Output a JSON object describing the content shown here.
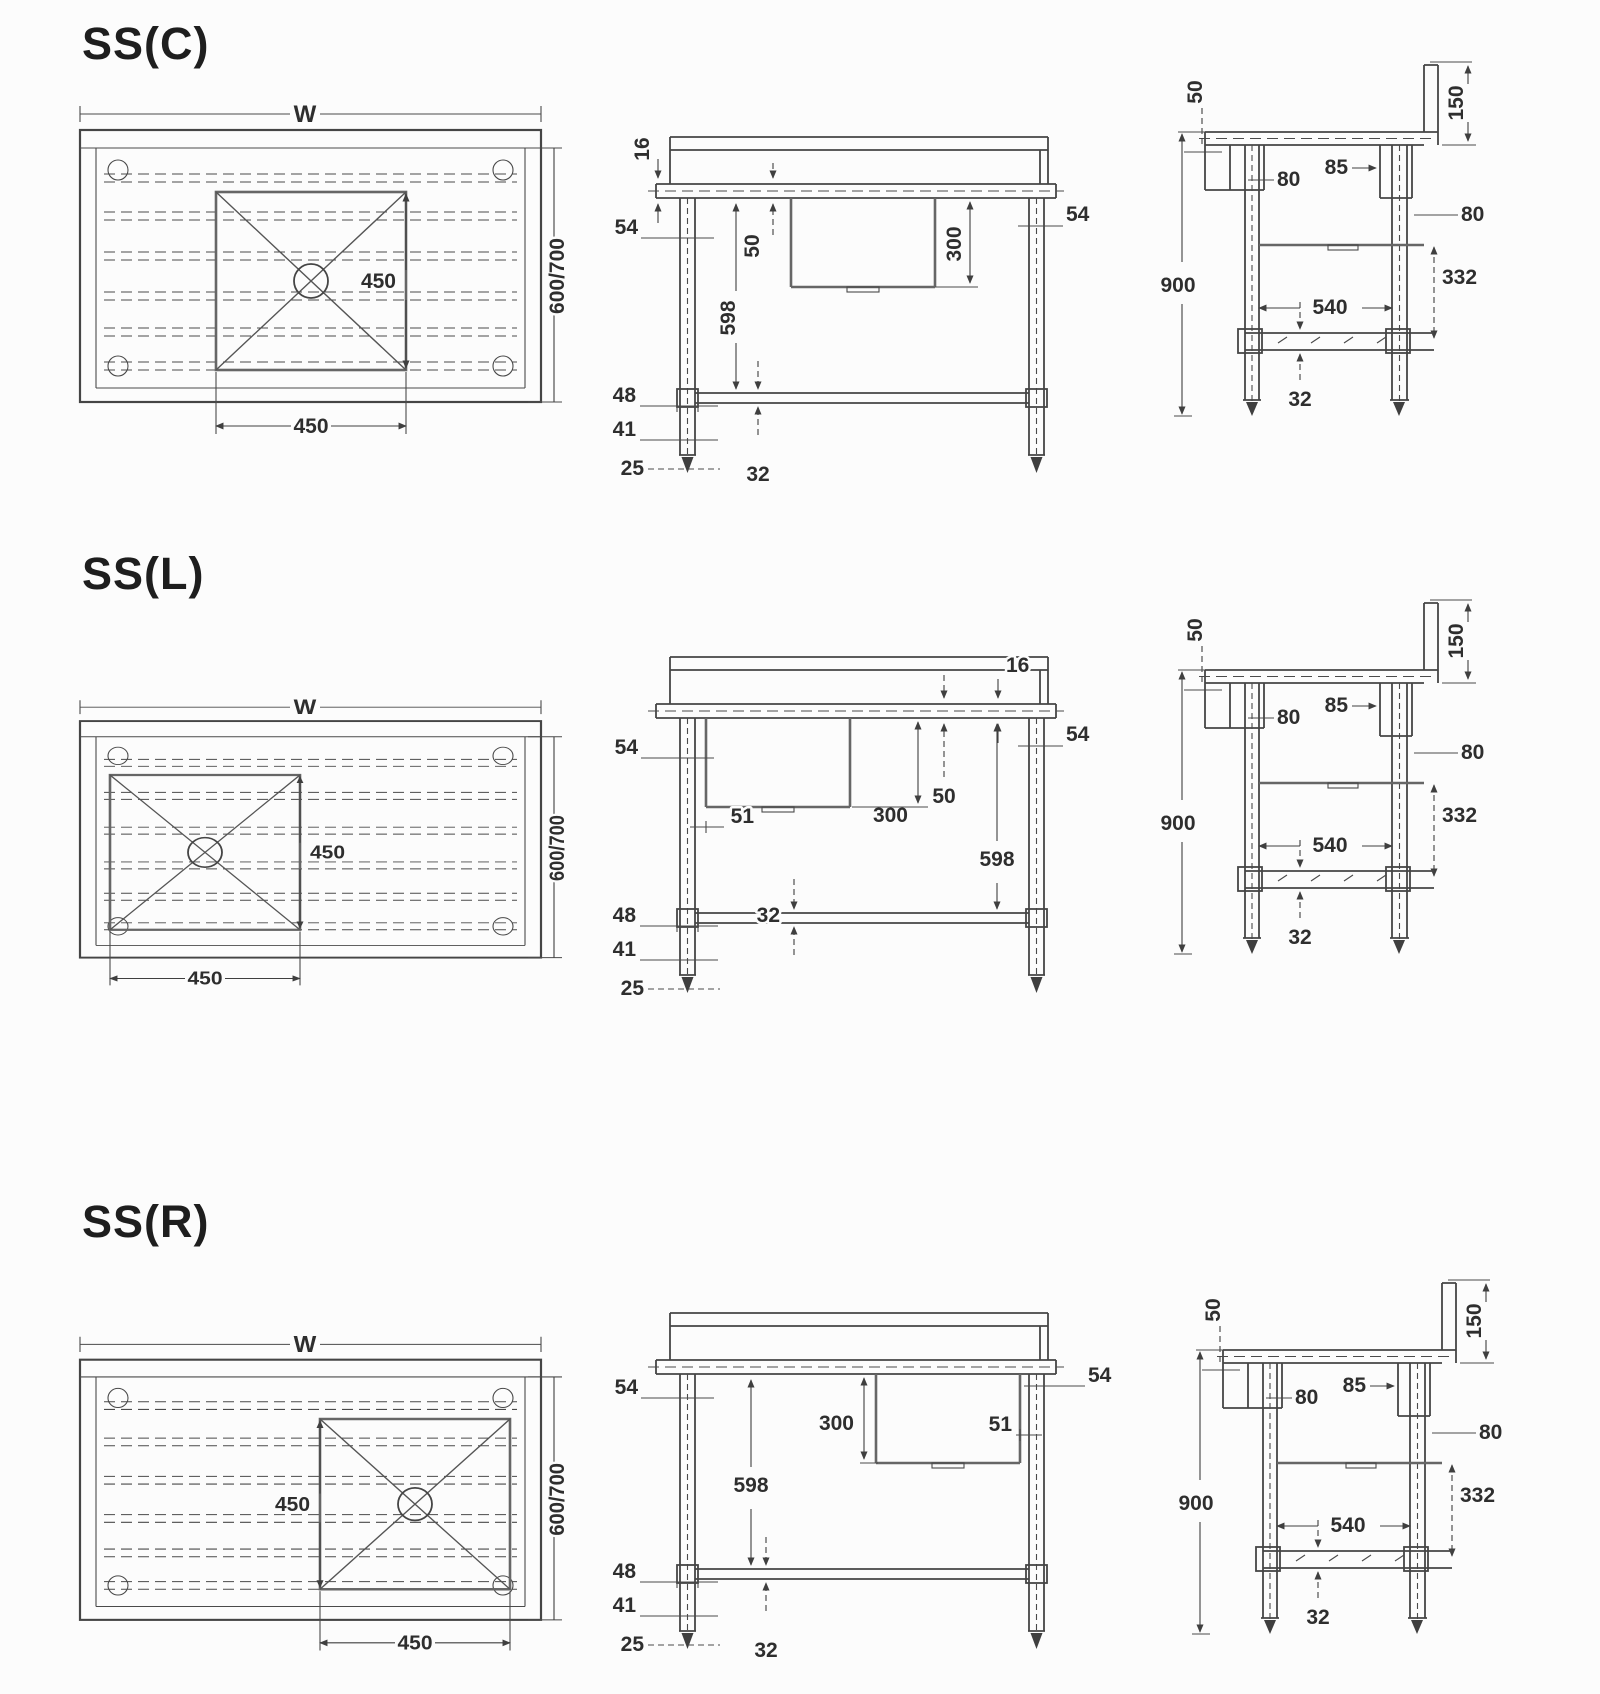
{
  "drawing": {
    "background": "#fcfcfc",
    "line_color": "#454545",
    "rows": [
      {
        "title": "SS(C)",
        "plan": {
          "width": "W",
          "depth": "600/700",
          "sink_side": "450",
          "sink_width": "450"
        },
        "front": {
          "top_thickness": "16",
          "left_leg": "54",
          "right_leg": "54",
          "apron": "50",
          "height": "598",
          "sink_depth": "300",
          "joint": "48",
          "leg": "41",
          "foot": "25",
          "rail": "32"
        },
        "side": {
          "overhang": "50",
          "splashback": "150",
          "rear_gap": "85",
          "front_channel": "80",
          "rear_channel": "80",
          "total_height": "900",
          "bowl_to_shelf": "332",
          "leg_span": "540",
          "tube": "32"
        }
      },
      {
        "title": "SS(L)",
        "plan": {
          "width": "W",
          "depth": "600/700",
          "sink_side": "450",
          "sink_width": "450"
        },
        "front": {
          "top_thickness": "16",
          "left_leg": "54",
          "right_leg": "54",
          "offset": "51",
          "apron": "50",
          "height": "598",
          "sink_depth": "300",
          "joint": "48",
          "leg": "41",
          "foot": "25",
          "rail": "32"
        },
        "side": {
          "overhang": "50",
          "splashback": "150",
          "rear_gap": "85",
          "front_channel": "80",
          "rear_channel": "80",
          "total_height": "900",
          "bowl_to_shelf": "332",
          "leg_span": "540",
          "tube": "32"
        }
      },
      {
        "title": "SS(R)",
        "plan": {
          "width": "W",
          "depth": "600/700",
          "sink_side": "450",
          "sink_width": "450"
        },
        "front": {
          "left_leg": "54",
          "right_leg": "54",
          "offset": "51",
          "height": "598",
          "sink_depth": "300",
          "joint": "48",
          "leg": "41",
          "foot": "25",
          "rail": "32"
        },
        "side": {
          "overhang": "50",
          "splashback": "150",
          "rear_gap": "85",
          "front_channel": "80",
          "rear_channel": "80",
          "total_height": "900",
          "bowl_to_shelf": "332",
          "leg_span": "540",
          "tube": "32"
        }
      }
    ]
  }
}
